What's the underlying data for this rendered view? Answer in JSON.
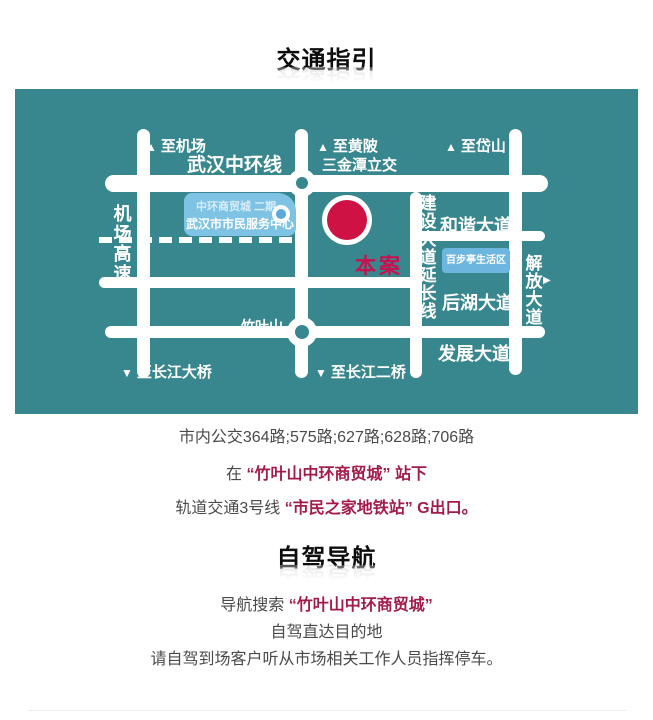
{
  "sections": {
    "transit_title": "交通指引",
    "driving_title": "自驾导航"
  },
  "transit": {
    "bus_line": "市内公交364路;575路;627路;628路;706路",
    "stop_prefix": "在 ",
    "stop_highlight": "“竹叶山中环商贸城” 站下",
    "metro_prefix": "轨道交通3号线 ",
    "metro_highlight": "“市民之家地铁站” G出口。"
  },
  "driving": {
    "nav_prefix": "导航搜索 ",
    "nav_highlight": "“竹叶山中环商贸城”",
    "line2": "自驾直达目的地",
    "line3": "请自驾到场客户听从市场相关工作人员指挥停车。"
  },
  "icons": {
    "up_triangle": "▲",
    "down_triangle": "▼",
    "right_triangle": "▶"
  },
  "map": {
    "bg_color": "#38878f",
    "road_color": "#ffffff",
    "marker_color": "#ce1244",
    "labels": {
      "to_airport": "至机场",
      "ring_road": "武汉中环线",
      "to_huangpi": "至黄陂",
      "interchange": "三金潭立交",
      "to_daishan": "至岱山",
      "airport_expressway": "机场高速",
      "mall_line1": "中环商贸城 二期",
      "mall_line2": "武汉市市民服务中心",
      "site_marker": "本案",
      "jianshe_ext": "建设大道延长线",
      "hexie_ave": "和谐大道",
      "baibuting": "百步亭生活区",
      "jiefang_ave": "解放大道",
      "houhu_ave": "后湖大道",
      "zhuyeshan": "竹叶山",
      "fazhan_ave": "发展大道",
      "to_yangtze_bridge1": "至长江大桥",
      "to_yangtze_bridge2": "至长江二桥"
    }
  }
}
